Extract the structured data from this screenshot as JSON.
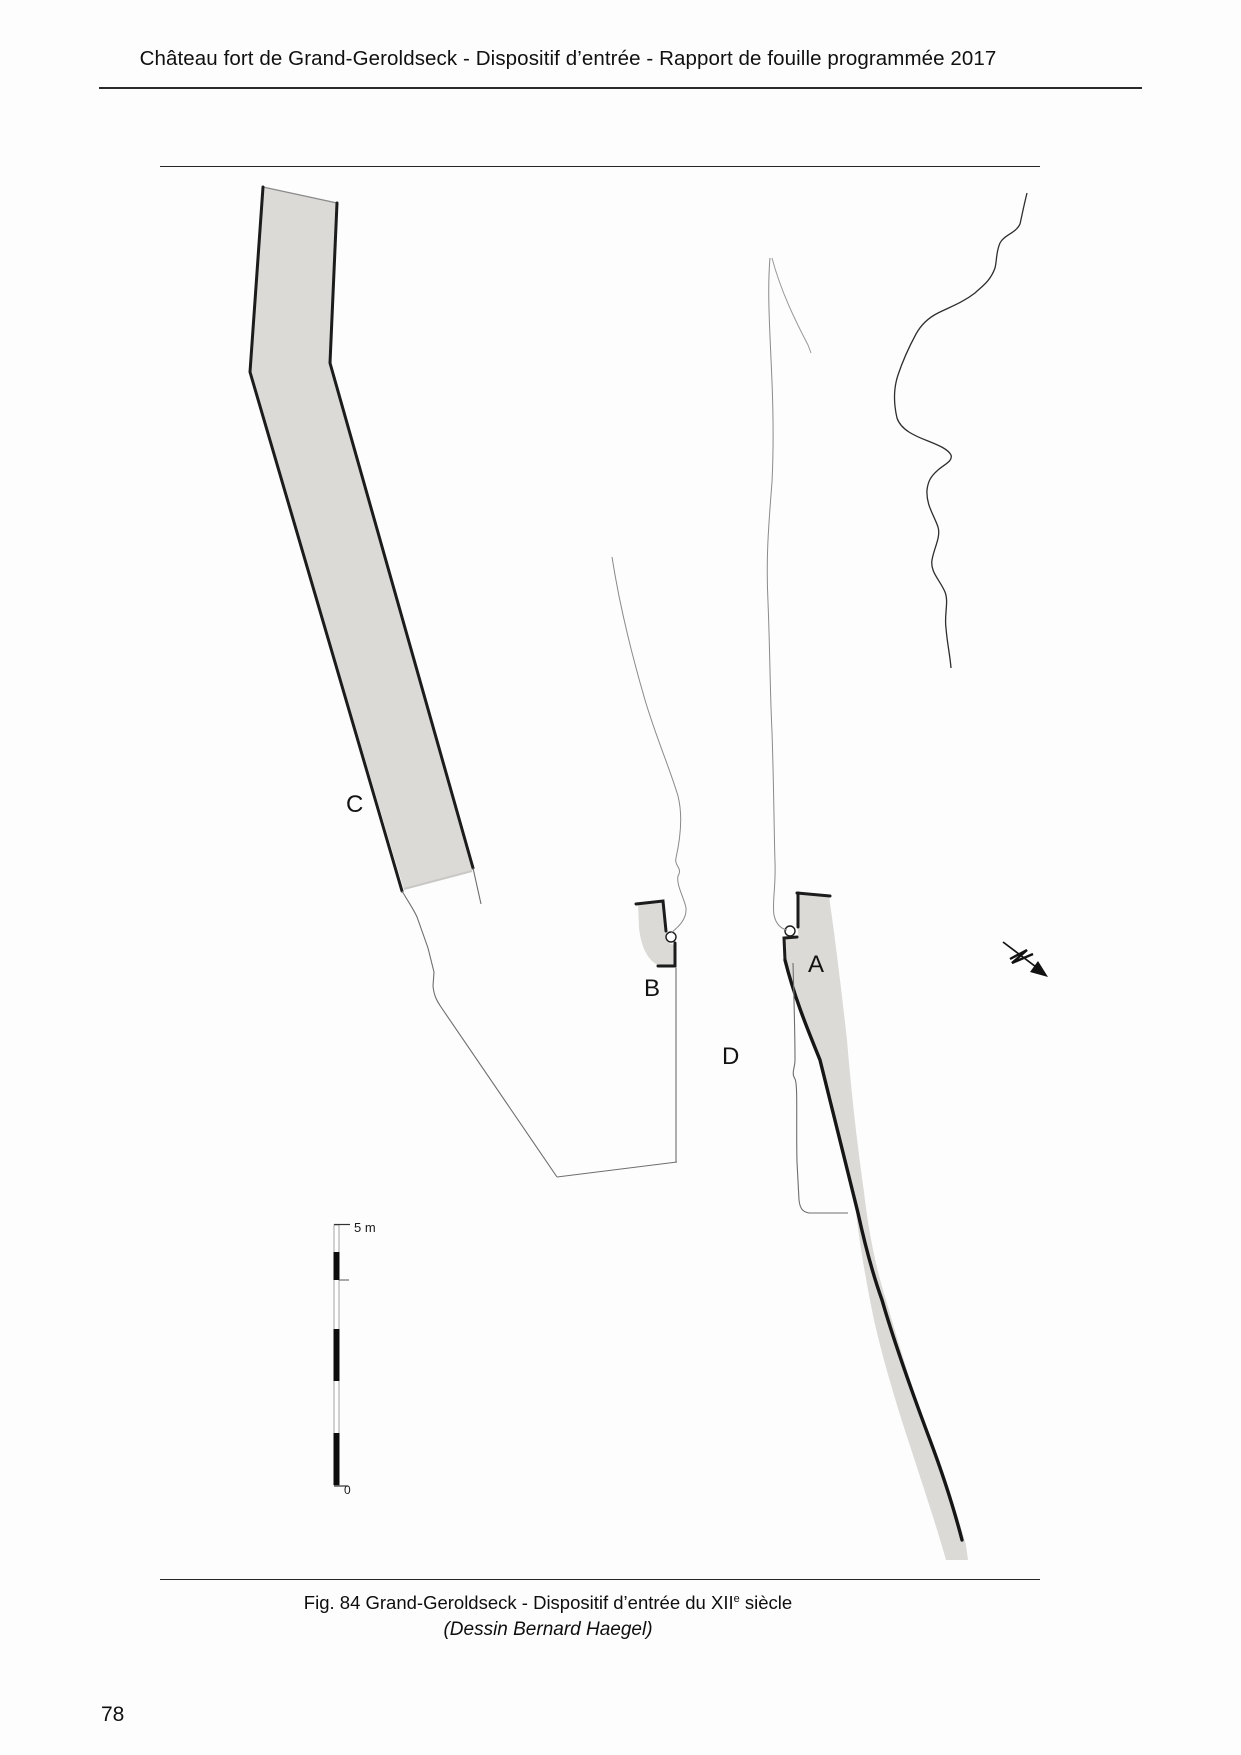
{
  "header": {
    "title": "Château fort de Grand-Geroldseck - Dispositif d’entrée - Rapport de fouille programmée 2017"
  },
  "figure": {
    "labels": {
      "a": "A",
      "b": "B",
      "c": "C",
      "d": "D"
    },
    "scale_bar": {
      "top_label": "5 m",
      "bottom_label": "0"
    },
    "north_arrow_icon": "north-arrow-icon",
    "colors": {
      "wall_fill": "#dbdad7",
      "wall_outline": "#1c1c1c",
      "thin_line": "#6e6e6e",
      "contour_line": "#2e2e2e"
    }
  },
  "caption": {
    "line1_prefix": "Fig. 84 Grand-Geroldseck - Dispositif d’entrée du XII",
    "line1_sup": "e",
    "line1_suffix": " siècle",
    "line2": "(Dessin Bernard Haegel)"
  },
  "page": {
    "number": "78"
  }
}
